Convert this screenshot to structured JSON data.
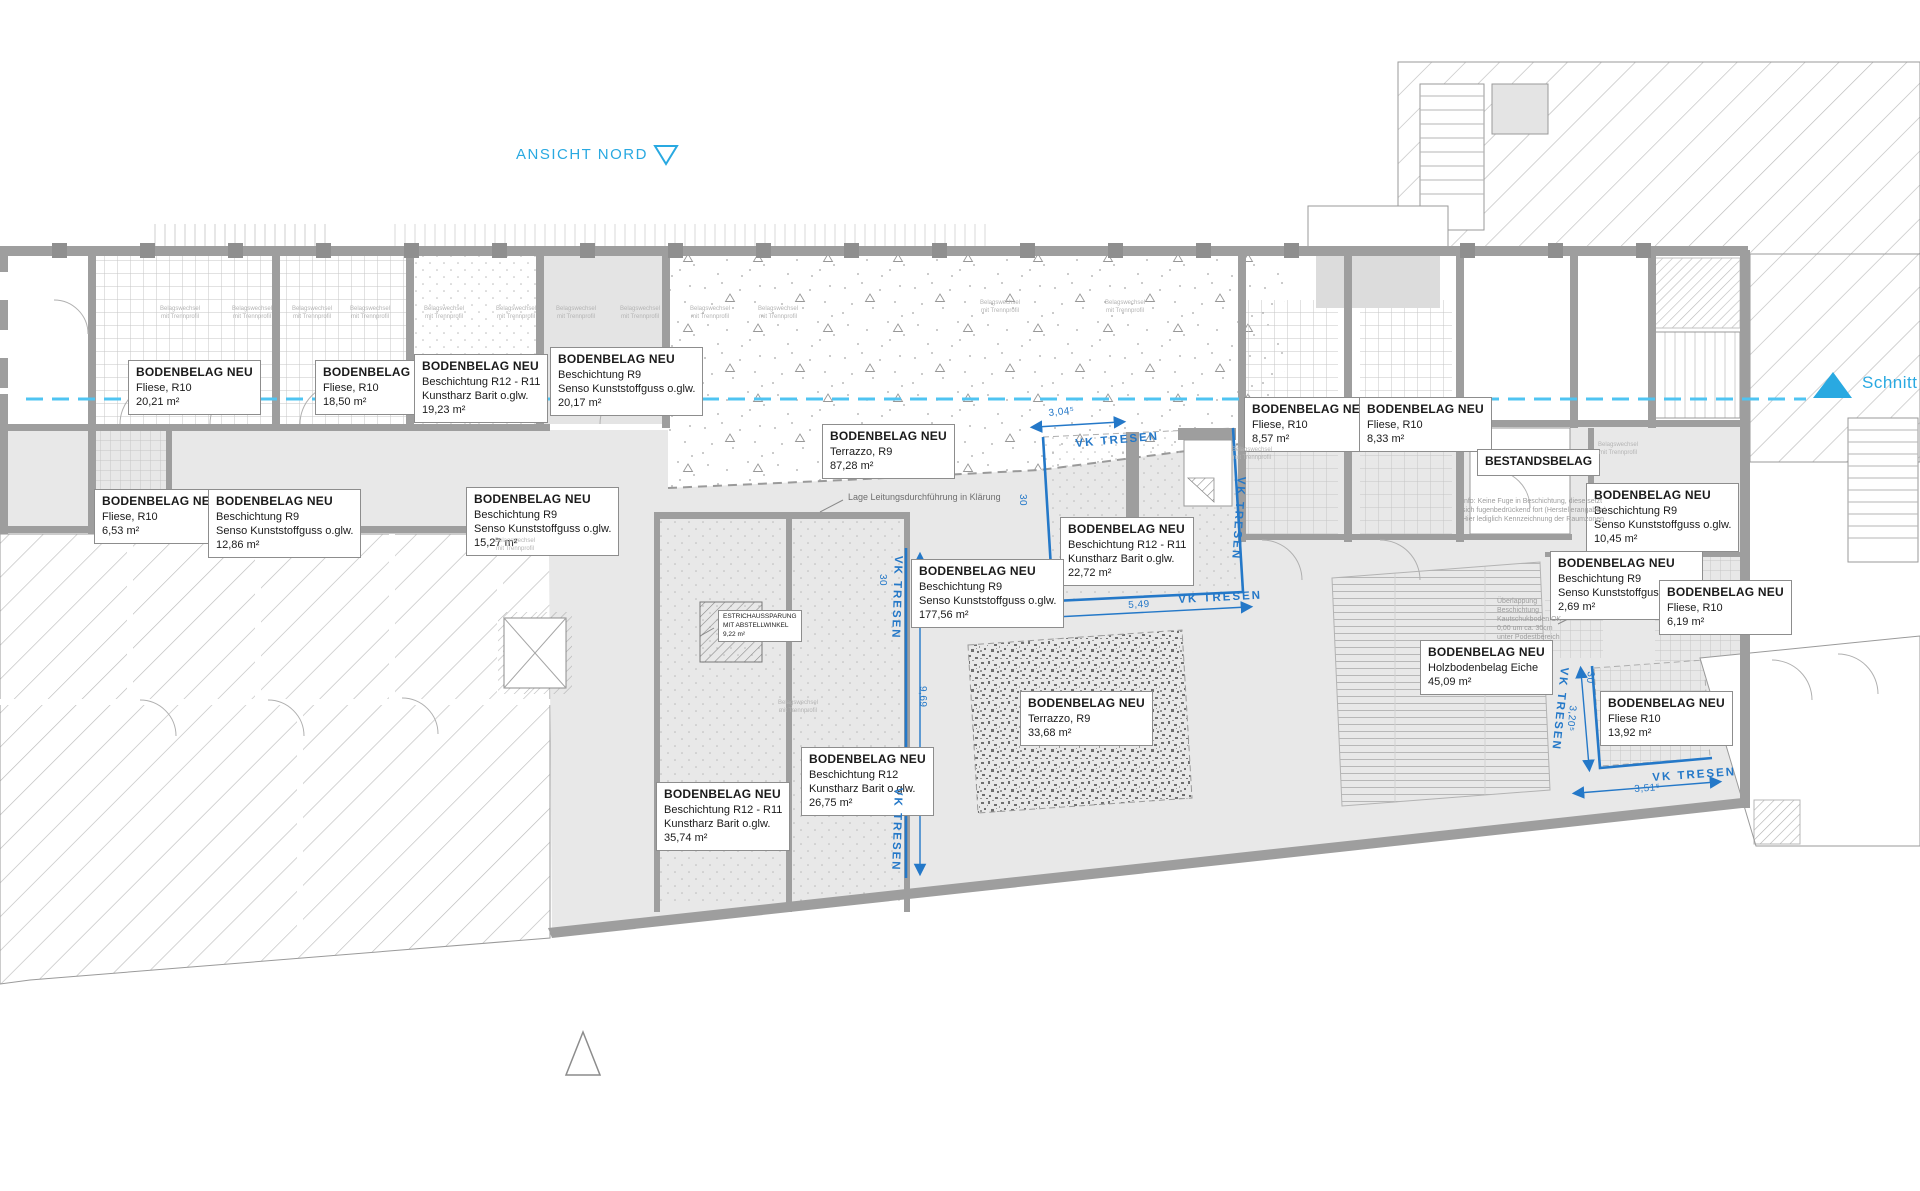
{
  "header": {
    "ansicht_nord": "ANSICHT NORD",
    "schnitt_aa": "Schnitt AA"
  },
  "colors": {
    "accent_cyan": "#29a9e1",
    "section_line_cyan": "#4fc4f2",
    "counter_blue": "#2478c8",
    "wall_gray": "#9e9e9e",
    "floor_gray": "#e8e8e8"
  },
  "floor_label_title": "BODENBELAG NEU",
  "floor_labels": [
    {
      "x": 128,
      "y": 360,
      "lines": [
        "Fliese, R10",
        "20,21 m²"
      ]
    },
    {
      "x": 315,
      "y": 360,
      "lines": [
        "Fliese, R10",
        "18,50 m²"
      ]
    },
    {
      "x": 414,
      "y": 354,
      "lines": [
        "Beschichtung R12 - R11",
        "Kunstharz Barit o.glw.",
        "19,23 m²"
      ]
    },
    {
      "x": 550,
      "y": 347,
      "lines": [
        "Beschichtung R9",
        "Senso Kunststoffguss o.glw.",
        "20,17 m²"
      ]
    },
    {
      "x": 822,
      "y": 424,
      "lines": [
        "Terrazzo, R9",
        "87,28 m²"
      ]
    },
    {
      "x": 1060,
      "y": 517,
      "lines": [
        "Beschichtung R12 - R11",
        "Kunstharz Barit o.glw.",
        "22,72 m²"
      ]
    },
    {
      "x": 1244,
      "y": 397,
      "lines": [
        "Fliese, R10",
        "8,57 m²"
      ]
    },
    {
      "x": 1359,
      "y": 397,
      "lines": [
        "Fliese, R10",
        "8,33 m²"
      ]
    },
    {
      "x": 1586,
      "y": 483,
      "lines": [
        "Beschichtung R9",
        "Senso Kunststoffguss o.glw.",
        "10,45 m²"
      ]
    },
    {
      "x": 1550,
      "y": 551,
      "lines": [
        "Beschichtung R9",
        "Senso Kunststoffguss o.glw.",
        "2,69 m²"
      ]
    },
    {
      "x": 1659,
      "y": 580,
      "lines": [
        "Fliese, R10",
        "6,19 m²"
      ]
    },
    {
      "x": 1420,
      "y": 640,
      "lines": [
        "Holzbodenbelag Eiche",
        "45,09 m²"
      ]
    },
    {
      "x": 1600,
      "y": 691,
      "lines": [
        "Fliese R10",
        "13,92 m²"
      ]
    },
    {
      "x": 1020,
      "y": 691,
      "lines": [
        "Terrazzo, R9",
        "33,68 m²"
      ]
    },
    {
      "x": 801,
      "y": 747,
      "lines": [
        "Beschichtung R12",
        "Kunstharz Barit o.glw.",
        "26,75 m²"
      ]
    },
    {
      "x": 656,
      "y": 782,
      "lines": [
        "Beschichtung R12 - R11",
        "Kunstharz Barit o.glw.",
        "35,74 m²"
      ]
    },
    {
      "x": 94,
      "y": 489,
      "lines": [
        "Fliese, R10",
        "6,53 m²"
      ]
    },
    {
      "x": 208,
      "y": 489,
      "lines": [
        "Beschichtung R9",
        "Senso Kunststoffguss o.glw.",
        "12,86 m²"
      ]
    },
    {
      "x": 466,
      "y": 487,
      "lines": [
        "Beschichtung R9",
        "Senso Kunststoffguss o.glw.",
        "15,27 m²"
      ]
    },
    {
      "x": 911,
      "y": 559,
      "lines": [
        "Beschichtung R9",
        "Senso Kunststoffguss o.glw.",
        "177,56 m²"
      ]
    }
  ],
  "bestandsbelag": {
    "text": "BESTANDSBELAG",
    "x": 1477,
    "y": 449
  },
  "estrich": {
    "x": 718,
    "y": 610,
    "lines": [
      "ESTRICHAUSSPARUNG",
      "MIT ABSTELLWINKEL",
      "9,22 m²"
    ]
  },
  "counter_label_text": "VK TRESEN",
  "counter_labels": [
    {
      "x": 1075,
      "y": 438,
      "rot": -5
    },
    {
      "x": 1247,
      "y": 477,
      "rot": 94
    },
    {
      "x": 1178,
      "y": 594,
      "rot": -3
    },
    {
      "x": 904,
      "y": 556,
      "rot": 92
    },
    {
      "x": 904,
      "y": 788,
      "rot": 92
    },
    {
      "x": 1570,
      "y": 668,
      "rot": 96
    },
    {
      "x": 1652,
      "y": 772,
      "rot": -4
    }
  ],
  "dimensions": [
    {
      "t": "3,04⁵",
      "x": 1048,
      "y": 408,
      "rot": -6
    },
    {
      "t": "5,49",
      "x": 1128,
      "y": 600,
      "rot": -3
    },
    {
      "t": "9,69",
      "x": 928,
      "y": 686,
      "rot": 90
    },
    {
      "t": "30",
      "x": 1028,
      "y": 494,
      "rot": 90
    },
    {
      "t": "30",
      "x": 888,
      "y": 574,
      "rot": 90
    },
    {
      "t": "30",
      "x": 1596,
      "y": 672,
      "rot": 96
    },
    {
      "t": "3,20⁵",
      "x": 1578,
      "y": 706,
      "rot": 96
    },
    {
      "t": "3,51⁵",
      "x": 1634,
      "y": 784,
      "rot": -4
    }
  ],
  "small_note_lines": [
    "Belagswechsel",
    "mit Trennprofil"
  ],
  "small_note_positions": [
    {
      "x": 160,
      "y": 306
    },
    {
      "x": 232,
      "y": 306
    },
    {
      "x": 292,
      "y": 306
    },
    {
      "x": 350,
      "y": 306
    },
    {
      "x": 424,
      "y": 306
    },
    {
      "x": 496,
      "y": 306
    },
    {
      "x": 556,
      "y": 306
    },
    {
      "x": 620,
      "y": 306
    },
    {
      "x": 690,
      "y": 306
    },
    {
      "x": 758,
      "y": 306
    },
    {
      "x": 980,
      "y": 300
    },
    {
      "x": 1105,
      "y": 300
    },
    {
      "x": 1232,
      "y": 447
    },
    {
      "x": 495,
      "y": 538
    },
    {
      "x": 1598,
      "y": 442
    },
    {
      "x": 778,
      "y": 700
    }
  ],
  "annotations": {
    "lage": {
      "text": "Lage Leitungsdurchführung in Klärung",
      "x": 848,
      "y": 492
    },
    "info_note": {
      "x": 1462,
      "y": 497,
      "lines": [
        "Info: Keine Fuge in Beschichtung, diese setzt",
        "sich fugenbedrückend fort (Herstellerangaben)",
        "Hier lediglich Kennzeichnung der Raumzonen"
      ]
    },
    "ueberlappung": {
      "x": 1497,
      "y": 597,
      "lines": [
        "Überlappung",
        "Beschichtung",
        "Kautschukboden OK",
        "0,00 um ca. 30cm",
        "unter Podestbereich"
      ]
    }
  }
}
